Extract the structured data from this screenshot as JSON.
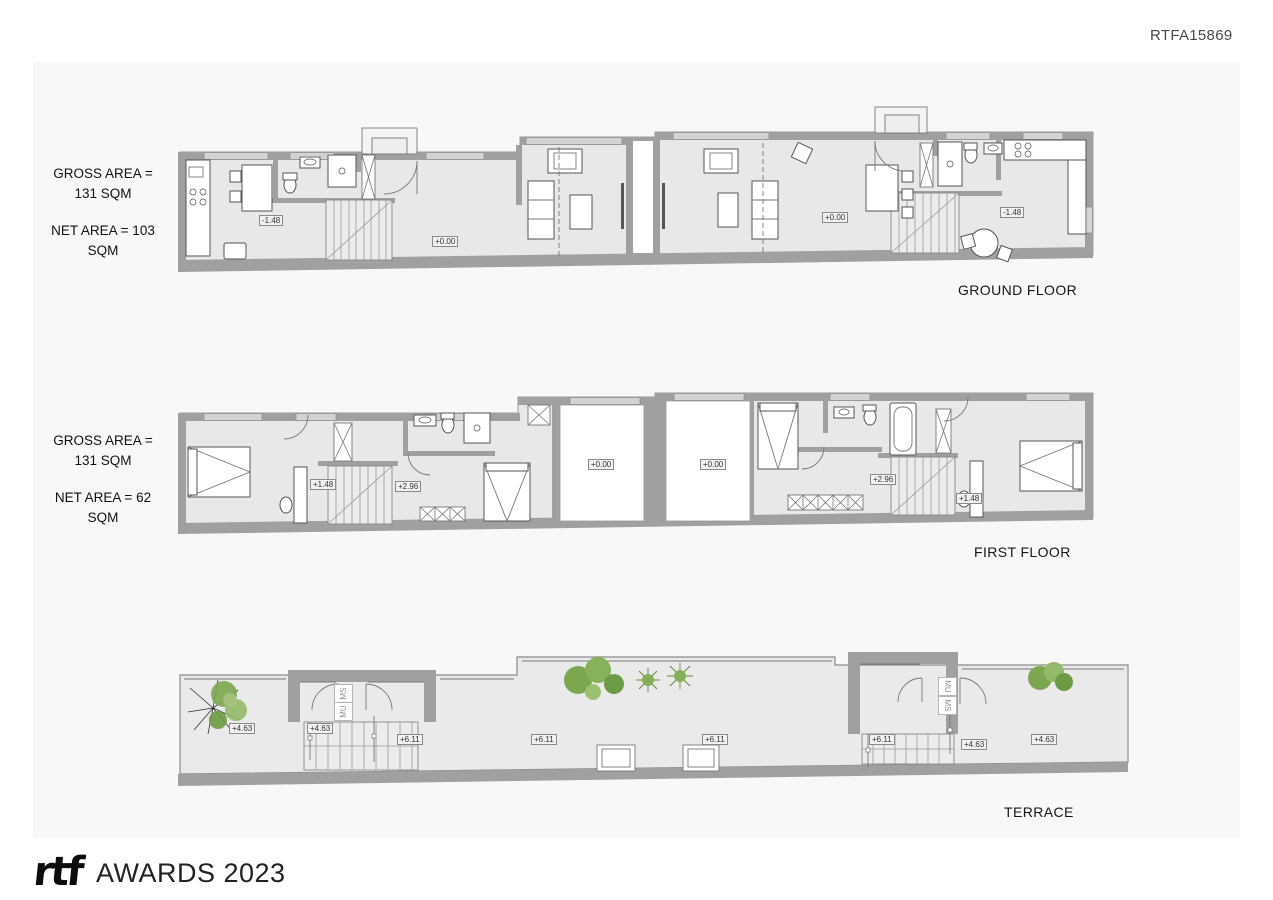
{
  "document": {
    "code": "RTFA15869"
  },
  "branding": {
    "logo_text": "rtf",
    "awards_text": "AWARDS 2023"
  },
  "colors": {
    "sheet_background": "#f8f8f7",
    "wall_gray": "#a0a0a0",
    "floor_gray": "#e8e8e7",
    "plant_green": "#7da650",
    "text_dark": "#161616"
  },
  "floors": [
    {
      "name": "GROUND FLOOR",
      "gross_area": "GROSS AREA = 131 SQM",
      "net_area": "NET AREA = 103 SQM",
      "markers": [
        {
          "text": "-1.48",
          "x": 259,
          "y": 215
        },
        {
          "text": "+0.00",
          "x": 432,
          "y": 236
        },
        {
          "text": "+0.00",
          "x": 822,
          "y": 212
        },
        {
          "text": "-1.48",
          "x": 1000,
          "y": 207
        }
      ]
    },
    {
      "name": "FIRST FLOOR",
      "gross_area": "GROSS AREA = 131 SQM",
      "net_area": "NET AREA = 62 SQM",
      "markers": [
        {
          "text": "+1.48",
          "x": 310,
          "y": 479
        },
        {
          "text": "+2.96",
          "x": 395,
          "y": 481
        },
        {
          "text": "+0.00",
          "x": 588,
          "y": 459
        },
        {
          "text": "+0.00",
          "x": 700,
          "y": 459
        },
        {
          "text": "+2.96",
          "x": 870,
          "y": 474
        },
        {
          "text": "+1.48",
          "x": 956,
          "y": 493
        }
      ]
    },
    {
      "name": "TERRACE",
      "markers": [
        {
          "text": "+4.63",
          "x": 229,
          "y": 723
        },
        {
          "text": "+4.63",
          "x": 307,
          "y": 723
        },
        {
          "text": "+6.11",
          "x": 397,
          "y": 734
        },
        {
          "text": "+6.11",
          "x": 531,
          "y": 734
        },
        {
          "text": "+6.11",
          "x": 702,
          "y": 734
        },
        {
          "text": "+6.11",
          "x": 869,
          "y": 734
        },
        {
          "text": "+4.63",
          "x": 961,
          "y": 739
        },
        {
          "text": "+4.63",
          "x": 1031,
          "y": 734
        }
      ],
      "stair_labels": [
        {
          "text": "MS",
          "x": 334,
          "y": 684,
          "rot": -90
        },
        {
          "text": "MU",
          "x": 334,
          "y": 702,
          "rot": -90
        },
        {
          "text": "MU",
          "x": 938,
          "y": 677,
          "rot": 90
        },
        {
          "text": "MS",
          "x": 938,
          "y": 696,
          "rot": 90
        }
      ]
    }
  ]
}
